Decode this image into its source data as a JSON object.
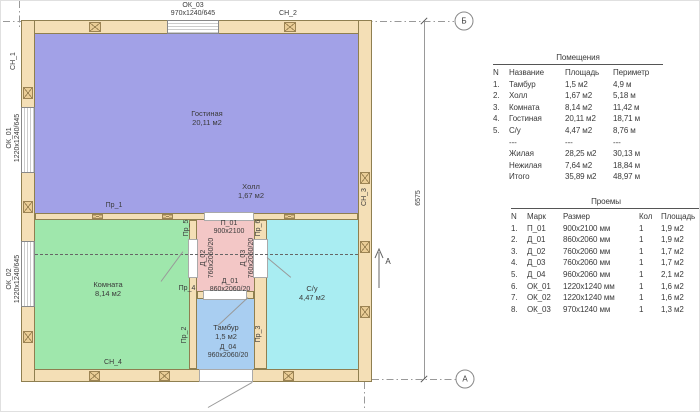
{
  "plan": {
    "axis_markers": {
      "top": "Б",
      "bottom": "А"
    },
    "dimension_6575": "6575",
    "section_arrow_label": "А",
    "wall_labels": {
      "sn1": "СН_1",
      "sn2": "СН_2",
      "sn3": "СН_3",
      "sn4": "СН_4"
    },
    "pr_labels": {
      "pr1": "Пр_1",
      "pr2": "Пр_2",
      "pr3": "Пр_3",
      "pr4": "Пр_4",
      "pr5": "Пр_5",
      "pr6": "Пр_6"
    },
    "windows": {
      "ok03": {
        "mark": "ОК_03",
        "size": "970х1240/645"
      },
      "ok01": {
        "mark": "ОК_01",
        "size": "1220х1240/645"
      },
      "ok02": {
        "mark": "ОК_02",
        "size": "1220х1240/645"
      }
    },
    "doors": {
      "p01": {
        "mark": "П_01",
        "size": "900х2100"
      },
      "d01": {
        "mark": "Д_01",
        "size": "860х2060/20"
      },
      "d02": {
        "mark": "Д_02",
        "size": "760х2060/20"
      },
      "d03": {
        "mark": "Д_03",
        "size": "760х2060/20"
      },
      "d04": {
        "mark": "Д_04",
        "size": "960х2060/20"
      }
    },
    "rooms": {
      "living": {
        "name": "Гостиная",
        "area": "20,11 м2"
      },
      "hall": {
        "name": "Холл",
        "area": "1,67 м2"
      },
      "bedroom": {
        "name": "Комната",
        "area": "8,14 м2"
      },
      "wc": {
        "name": "С/у",
        "area": "4,47 м2"
      },
      "tambour": {
        "name": "Тамбур",
        "area": "1,5 м2"
      }
    }
  },
  "rooms_table": {
    "title": "Помещения",
    "headers": [
      "N",
      "Название",
      "Площадь",
      "Периметр"
    ],
    "rows": [
      [
        "1.",
        "Тамбур",
        "1,5 м2",
        "4,9 м"
      ],
      [
        "2.",
        "Холл",
        "1,67 м2",
        "5,18 м"
      ],
      [
        "3.",
        "Комната",
        "8,14 м2",
        "11,42 м"
      ],
      [
        "4.",
        "Гостиная",
        "20,11 м2",
        "18,71 м"
      ],
      [
        "5.",
        "С/у",
        "4,47 м2",
        "8,76 м"
      ],
      [
        "",
        "---",
        "---",
        "---"
      ],
      [
        "",
        "Жилая",
        "28,25 м2",
        "30,13 м"
      ],
      [
        "",
        "Нежилая",
        "7,64 м2",
        "18,84 м"
      ],
      [
        "",
        "Итого",
        "35,89 м2",
        "48,97 м"
      ]
    ]
  },
  "openings_table": {
    "title": "Проемы",
    "headers": [
      "N",
      "Марк",
      "Размер",
      "Кол",
      "Площадь"
    ],
    "rows": [
      [
        "1.",
        "П_01",
        "900х2100 мм",
        "1",
        "1,9 м2"
      ],
      [
        "2.",
        "Д_01",
        "860х2060 мм",
        "1",
        "1,9 м2"
      ],
      [
        "3.",
        "Д_02",
        "760х2060 мм",
        "1",
        "1,7 м2"
      ],
      [
        "4.",
        "Д_03",
        "760х2060 мм",
        "1",
        "1,7 м2"
      ],
      [
        "5.",
        "Д_04",
        "960х2060 мм",
        "1",
        "2,1 м2"
      ],
      [
        "6.",
        "ОК_01",
        "1220х1240 мм",
        "1",
        "1,6 м2"
      ],
      [
        "7.",
        "ОК_02",
        "1220х1240 мм",
        "1",
        "1,6 м2"
      ],
      [
        "8.",
        "ОК_03",
        "970х1240 мм",
        "1",
        "1,3 м2"
      ]
    ]
  },
  "colors": {
    "wall": "#f4dfb6",
    "living_room_fill": "#a2a1e7",
    "bedroom_fill": "#9fe7ac",
    "wc_fill": "#a9edf2",
    "tambour_fill": "#a9cef1",
    "inner_hall_fill": "#f3c7c6"
  }
}
